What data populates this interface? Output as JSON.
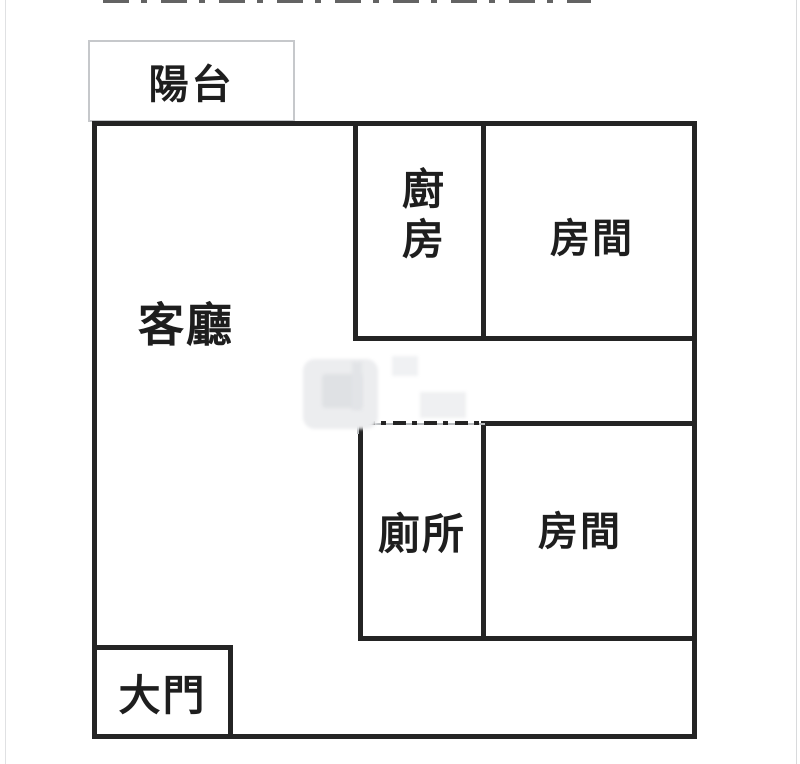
{
  "floorplan": {
    "type": "apartment-floor-plan",
    "rooms": {
      "balcony": {
        "label": "陽台"
      },
      "living_room": {
        "label": "客廳"
      },
      "kitchen": {
        "label": "廚房",
        "text_orientation": "vertical"
      },
      "bedroom_top": {
        "label": "房間"
      },
      "toilet": {
        "label": "廁所",
        "top_wall_style": "dash-dot"
      },
      "bedroom_bottom": {
        "label": "房間"
      },
      "main_door": {
        "label": "大門"
      }
    },
    "colors": {
      "background": "#ffffff",
      "wall": "#242424",
      "thin_line": "#c6c8cb",
      "text": "#1e1e1e",
      "watermark": "#ecedef"
    },
    "artifacts": {
      "top_edge": "bottom sliver of cropped-off text along top edge",
      "watermark": "faint illegible gray watermark left of lower rooms"
    }
  }
}
